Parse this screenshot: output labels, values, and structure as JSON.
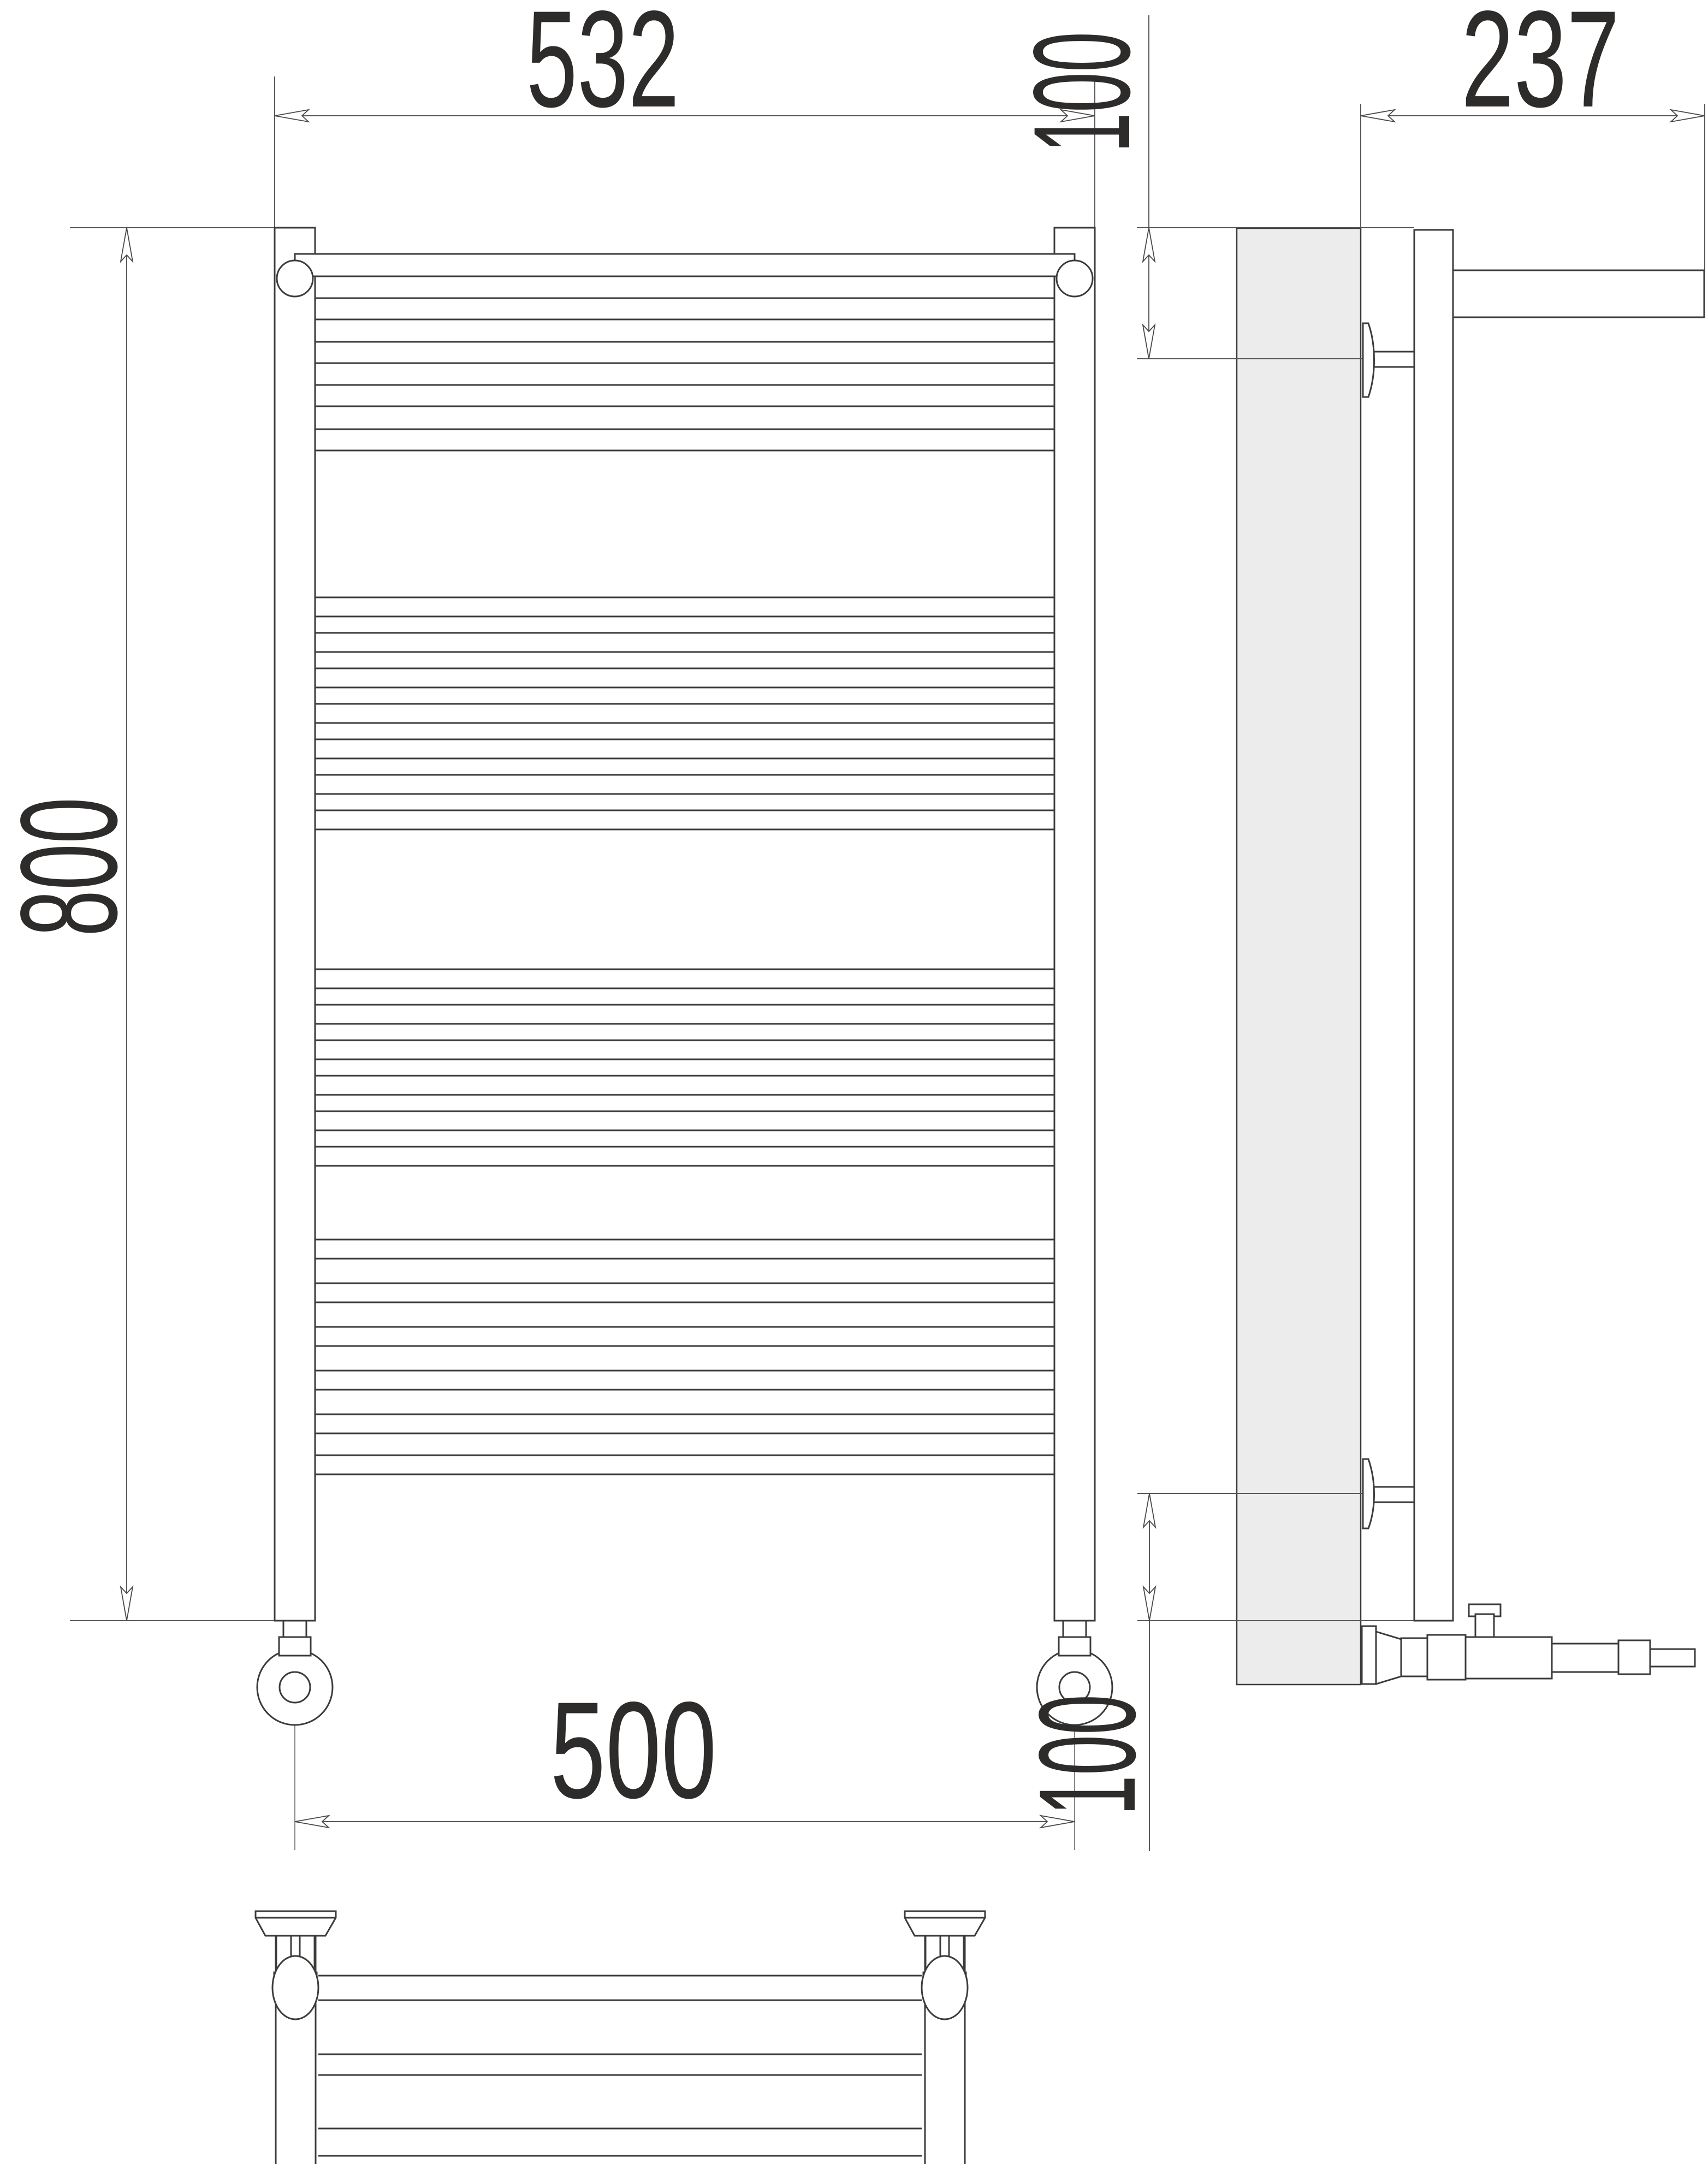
{
  "drawing": {
    "kind": "towel-radiator-dimension-drawing",
    "units": "mm",
    "dimensions": {
      "width_overall": "532",
      "height_overall": "800",
      "connection_spacing": "500",
      "depth_overall": "237",
      "top_bracket_offset": "100",
      "bottom_bracket_offset": "100"
    },
    "colors": {
      "line": "#3d3b3a",
      "dim_line": "#5a5856",
      "text": "#2e2c2b",
      "wall_fill": "#ececec",
      "background": "#ffffff"
    }
  }
}
